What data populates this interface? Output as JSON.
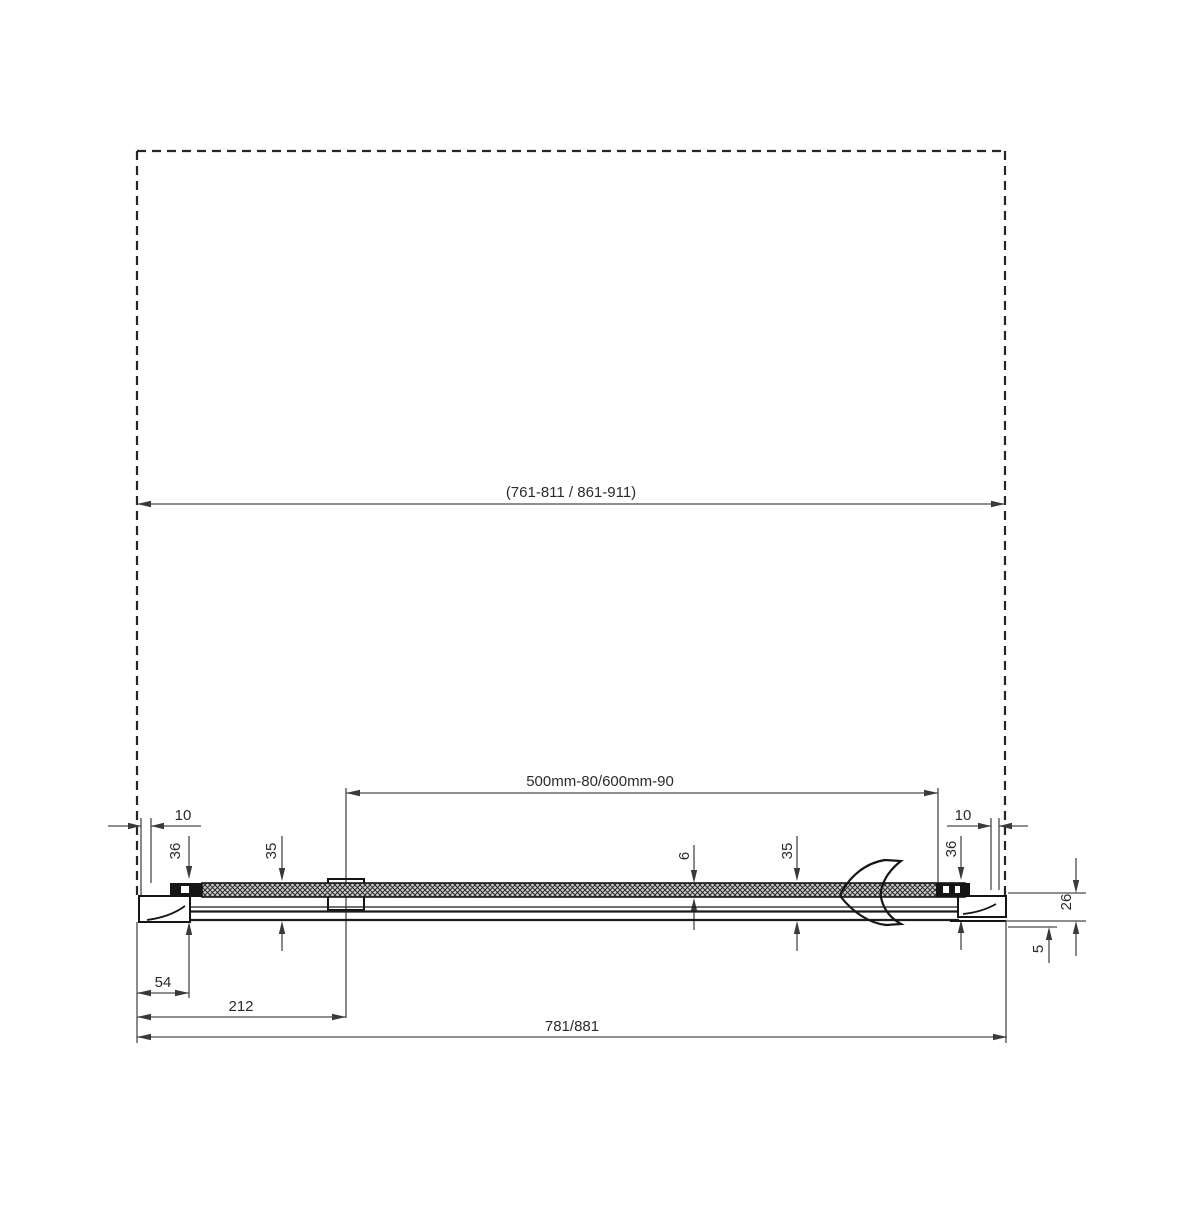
{
  "drawing": {
    "type": "shower-door-plan-cross-section",
    "dims": {
      "width_range": "(761-811 / 861-911)",
      "door_glass": "500mm-80/600mm-90",
      "total": "781/881",
      "wall_gap_left": "10",
      "wall_profile_left": "36",
      "door_depth_left": "35",
      "glass_thickness": "6",
      "door_depth_right": "35",
      "wall_gap_right": "10",
      "wall_profile_right": "36",
      "rail_depth": "26",
      "rail_lip": "5",
      "offset_54": "54",
      "offset_212": "212"
    }
  }
}
